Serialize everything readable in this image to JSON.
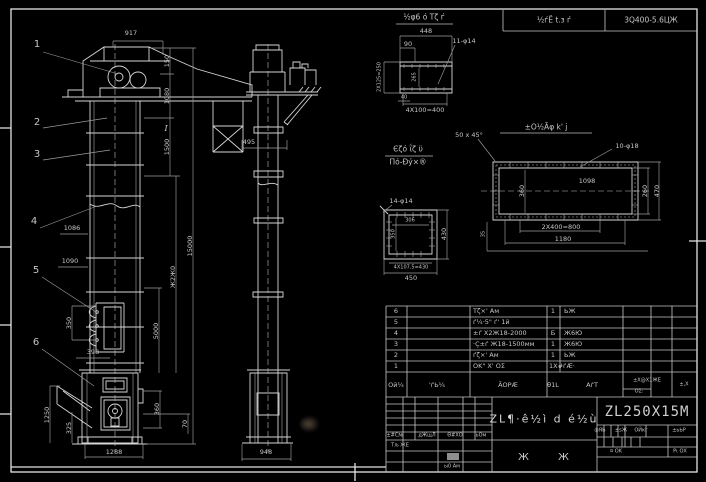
{
  "top_bar": {
    "cell1": "½ѓЁ t.з ѓ",
    "cell2": "3Q400-5.6ЦЖ"
  },
  "front": {
    "balloons": [
      "1",
      "2",
      "3",
      "4",
      "5",
      "6"
    ],
    "section_mark": "I",
    "dims": {
      "w917": "917",
      "h150": "150",
      "h1080": "1080",
      "h1500": "1500",
      "total": "15000",
      "mid_note": "Ж2Ж0",
      "mid5000": "5000",
      "wall1": "1086",
      "wall2": "1090",
      "bucket_pitch": "350",
      "bucket_w": "398",
      "boot_h": "1250",
      "boot_inner": "325",
      "boot_w": "1288",
      "outlet_h": "360",
      "outlet_off": "70"
    }
  },
  "side": {
    "dims": {
      "depth": "495",
      "boot_depth": "948"
    }
  },
  "detail_a": {
    "title": "½φ6 ό Τζ ѓ",
    "dims": {
      "top": "448",
      "offset": "90",
      "holes": "11-φ14",
      "left": "2X125=250",
      "inner": "265",
      "small": "40",
      "bottom": "4X100=400"
    }
  },
  "detail_b": {
    "title_1": "Єζό ΐζ ϋ",
    "title_2": "Πό-Đý×®",
    "dims": {
      "holes": "14-φ14",
      "inner_w": "306",
      "inner_h": "350",
      "right": "430",
      "bottom_1": "4X107.5=430",
      "bottom_2": "450"
    }
  },
  "detail_c": {
    "title": "±Ο½Ãφ k' ј",
    "chamfer": "50 x 45°",
    "dims": {
      "holes": "10-φ18",
      "inner": "1098",
      "left": "360",
      "right_1": "260",
      "right_2": "470",
      "bottom_1": "2X400=800",
      "bottom_2": "1180",
      "left_small": "35"
    }
  },
  "bom": {
    "headers": {
      "no": "Ой¼",
      "code": "'ѓЬ¼",
      "name": "ÃΟΡÆ",
      "qty": "θ1L",
      "material": "АѓТ",
      "weight_1": "±Х@Х1ЖЕ",
      "weight_2": "ΟΣ:",
      "note": "±,Х΢"
    },
    "rows": [
      {
        "no": "6",
        "name": "Тζ×' Ам",
        "qty": "1",
        "material": "ЬЖ"
      },
      {
        "no": "5",
        "name": "ѓ¼·5\" ѓ' 1й",
        "qty": "",
        "material": ""
      },
      {
        "no": "4",
        "name": "±ѓ X2Ж18-2000",
        "qty": "Б",
        "material": "Ж6Ю"
      },
      {
        "no": "3",
        "name": "·Ç±ѓ Ж18-1500мм",
        "qty": "1",
        "material": "Ж6Ю"
      },
      {
        "no": "2",
        "name": "ѓζ×' Ам",
        "qty": "1",
        "material": "ЬЖ"
      },
      {
        "no": "1",
        "name": "ΟΚ\" Х' ΟΣ",
        "qty": "1Х#ѓÆ·",
        "material": ""
      }
    ]
  },
  "title_block": {
    "drawing_title": "ZL¶·ê½ì d é½ù",
    "model": "ZL250X15M",
    "sheet_label": "Ж Ж",
    "rev_headers": [
      "±#С№",
      "дЖщЛ",
      "Θ#ΧΟ",
      "ьΟм"
    ],
    "sig_1": "Тљ ЖЕ",
    "sig_2": "ы0 Ам",
    "stage_cells": [
      "фЯЬ",
      "±ѕЖ",
      "ΟЙкг",
      "±ьЬΡ"
    ],
    "sheet_x": "¤ ΟΚ",
    "sheet_y": "Ρι ΟΧ"
  }
}
